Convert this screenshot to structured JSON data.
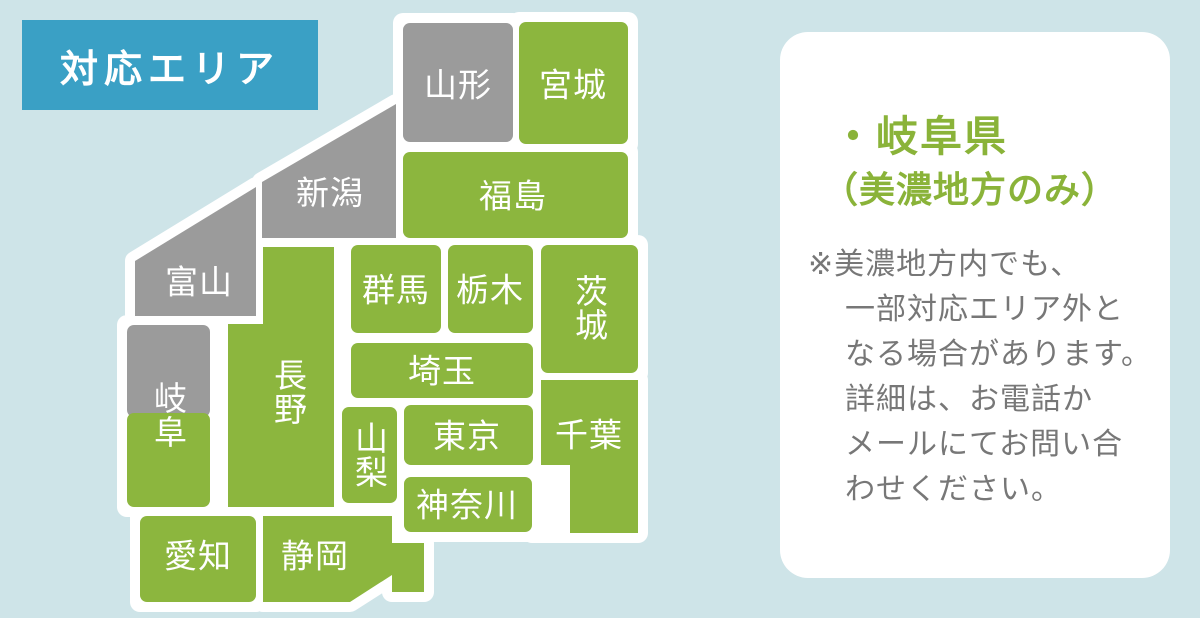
{
  "colors": {
    "background": "#cee4e8",
    "badge_blue": "#3aa0c5",
    "covered_green": "#8cb63e",
    "uncovered_gray": "#9b9b9b",
    "outline_white": "#ffffff",
    "heading_green": "#8ab339",
    "note_gray": "#777777"
  },
  "title": {
    "label": "対応エリア"
  },
  "map": {
    "legend_meaning": "green = covered area, gray = not covered",
    "prefectures": [
      {
        "name": "yamagata",
        "label": "山形",
        "covered": false
      },
      {
        "name": "miyagi",
        "label": "宮城",
        "covered": true
      },
      {
        "name": "niigata",
        "label": "新潟",
        "covered": false
      },
      {
        "name": "fukushima",
        "label": "福島",
        "covered": true
      },
      {
        "name": "toyama",
        "label": "富山",
        "covered": false
      },
      {
        "name": "gunma",
        "label": "群馬",
        "covered": true
      },
      {
        "name": "tochigi",
        "label": "栃木",
        "covered": true
      },
      {
        "name": "ibaraki",
        "label": "茨城",
        "covered": true
      },
      {
        "name": "saitama",
        "label": "埼玉",
        "covered": true
      },
      {
        "name": "nagano",
        "label": "長野",
        "covered": true
      },
      {
        "name": "gifu",
        "label": "岐阜",
        "covered": "partial"
      },
      {
        "name": "yamanashi",
        "label": "山梨",
        "covered": true
      },
      {
        "name": "tokyo",
        "label": "東京",
        "covered": true
      },
      {
        "name": "chiba",
        "label": "千葉",
        "covered": true
      },
      {
        "name": "kanagawa",
        "label": "神奈川",
        "covered": true
      },
      {
        "name": "aichi",
        "label": "愛知",
        "covered": true
      },
      {
        "name": "shizuoka",
        "label": "静岡",
        "covered": true
      }
    ]
  },
  "card": {
    "heading": "・岐阜県",
    "subheading": "（美濃地方のみ）",
    "note": "※美濃地方内でも、\n一部対応エリア外と\nなる場合があります。\n詳細は、お電話か\nメールにてお問い合\nわせください。"
  }
}
